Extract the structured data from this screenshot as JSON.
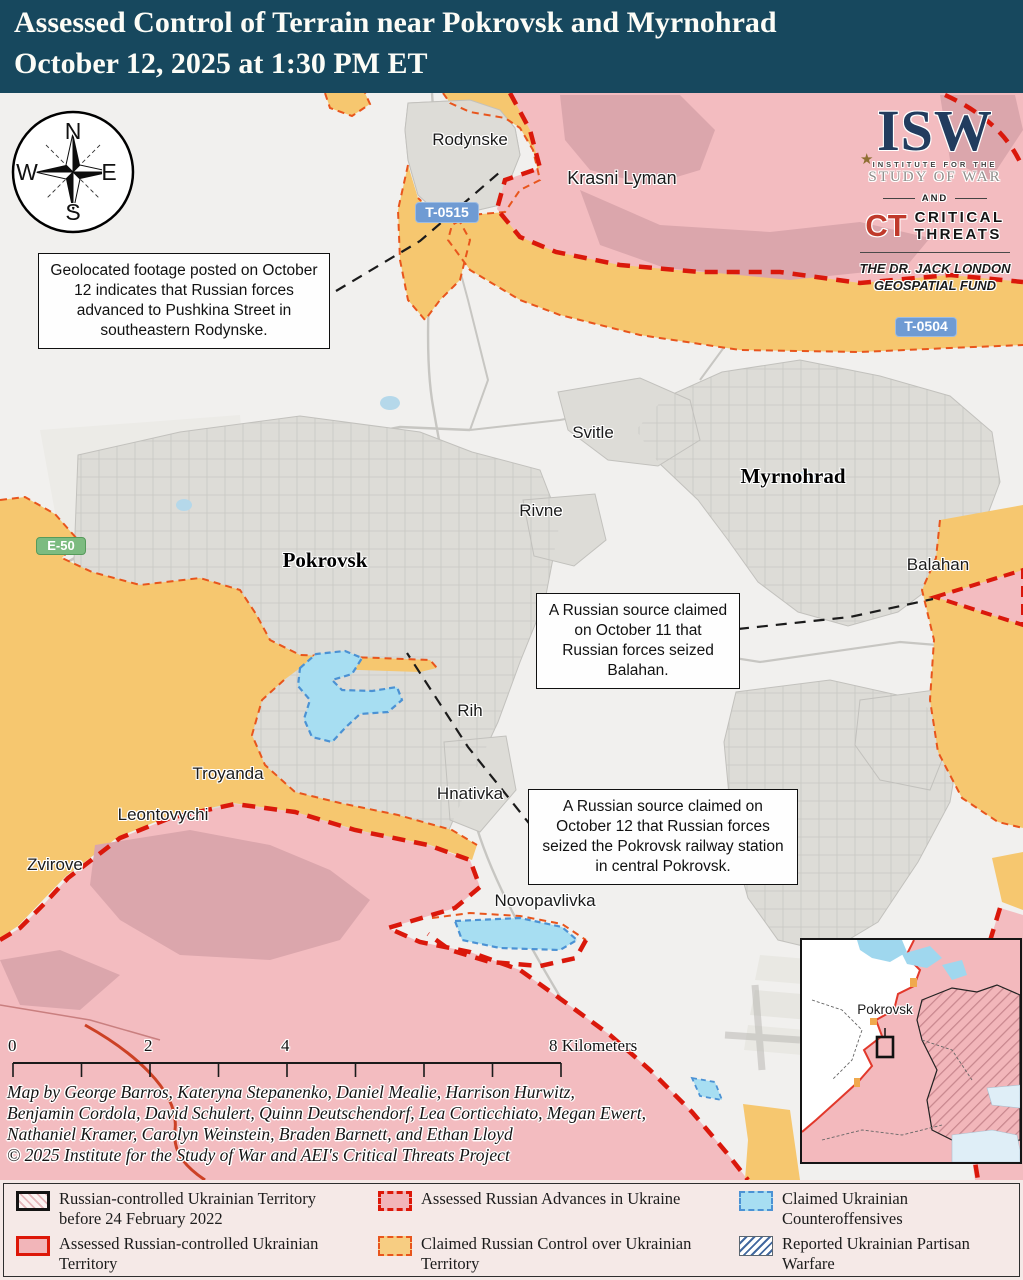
{
  "header": {
    "title_line1": "Assessed Control of Terrain near Pokrovsk and Myrnohrad",
    "title_line2": "October 12, 2025 at 1:30 PM ET"
  },
  "compass": {
    "north": "N",
    "east": "E",
    "south": "S",
    "west": "W"
  },
  "logos": {
    "isw": "ISW",
    "star": "★",
    "institute": "INSTITUTE FOR THE",
    "study": "STUDY OF WAR",
    "and_word": "AND",
    "ct": "CT",
    "critical": "CRITICAL",
    "threats": "THREATS",
    "fund_line1": "THE DR. JACK LONDON",
    "fund_line2": "GEOSPATIAL FUND"
  },
  "road_signs": {
    "t0515": "T-0515",
    "t0504": "T-0504",
    "e50": "E-50"
  },
  "places": {
    "rodynske": "Rodynske",
    "krasni_lyman": "Krasni Lyman",
    "svitle": "Svitle",
    "myrnohrad": "Myrnohrad",
    "rivne": "Rivne",
    "pokrovsk": "Pokrovsk",
    "balahan": "Balahan",
    "rih": "Rih",
    "hnativka": "Hnativka",
    "troyanda": "Troyanda",
    "leontovychi": "Leontovychi",
    "zvirove": "Zvirove",
    "novopavlivka": "Novopavlivka"
  },
  "callouts": {
    "rodynske": "Geolocated footage posted on October 12 indicates that Russian forces advanced to Pushkina Street in southeastern Rodynske.",
    "balahan": "A Russian source claimed on October 11 that Russian forces seized Balahan.",
    "railway": "A Russian source claimed on October 12 that Russian forces seized the Pokrovsk railway station in central Pokrovsk."
  },
  "scale_bar": {
    "tick0": "0",
    "tick2": "2",
    "tick4": "4",
    "tick8": "8 Kilometers"
  },
  "credits": {
    "line1": "Map by George Barros, Kateryna Stepanenko, Daniel Mealie, Harrison Hurwitz,",
    "line2": "Benjamin Cordola, David Schulert, Quinn Deutschendorf, Lea Corticchiato, Megan Ewert,",
    "line3": "Nathaniel Kramer, Carolyn Weinstein, Braden Barnett, and Ethan Lloyd",
    "line4": "© 2025 Institute for the Study of War and AEI's Critical Threats Project"
  },
  "inset": {
    "label": "Pokrovsk"
  },
  "legend": {
    "items": [
      {
        "label": "Russian-controlled Ukrainian Territory before 24 February 2022"
      },
      {
        "label": "Assessed Russian-controlled Ukrainian Territory"
      },
      {
        "label": "Assessed Russian Advances in Ukraine"
      },
      {
        "label": "Claimed Russian Control over Ukrainian Territory"
      },
      {
        "label": "Claimed Ukrainian Counteroffensives"
      },
      {
        "label": "Reported Ukrainian Partisan Warfare"
      }
    ]
  },
  "colors": {
    "header_bg": "#17485e",
    "russian_controlled": "#f3bcc0",
    "russian_urban": "#dba6ac",
    "claimed_russian_control": "#f6c76f",
    "assessed_advance_border": "#da180b",
    "claimed_control_border": "#e8551c",
    "ukrainian_counteroffensive": "#a7def2",
    "counteroffensive_border": "#4b92d4",
    "partisan_hatch_blue": "#43699f",
    "road_sign_blue": "#6f9bd3",
    "road_sign_green": "#7cbb80",
    "isw_navy": "#223c5e",
    "ct_red": "#c03a2b"
  }
}
